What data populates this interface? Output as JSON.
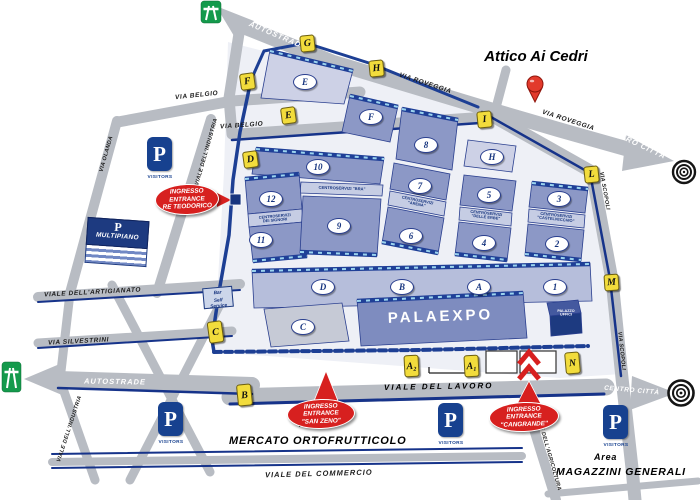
{
  "title": "Attico Ai Cedri",
  "colors": {
    "entrance_red": "#d7201f",
    "navy": "#1d3f94",
    "hall_blue": "#8c98c6",
    "gate_yellow": "#f2dc3c",
    "road_gray": "#b8bcc3",
    "highway_green": "#149a4c",
    "pin_red": "#e23a2c"
  },
  "gates": {
    "g": "G",
    "h": "H",
    "f": "F",
    "e": "E",
    "d": "D",
    "i": "I",
    "l": "L",
    "m": "M",
    "c": "C",
    "b": "B",
    "a2": "A₂",
    "a1": "A₁",
    "n": "N"
  },
  "halls": {
    "e": "E",
    "f": "F",
    "h": "H",
    "hall10": "10",
    "hall12": "12",
    "hall11": "11",
    "hall9": "9",
    "hall8": "8",
    "hall7": "7",
    "hall6": "6",
    "hall5": "5",
    "hall4": "4",
    "hall3": "3",
    "hall2": "2",
    "hall1": "1",
    "a": "A",
    "b": "B",
    "c": "C",
    "d": "D"
  },
  "centroservizi": {
    "bra": "CENTROSERVIZI \"BRA\"",
    "signori_l1": "CENTROSERVIZI",
    "signori_l2": "DEI SIGNORI",
    "arena_l1": "CENTROSERVIZI",
    "arena_l2": "\"ARENA\"",
    "erbe_l1": "CENTROSERVIZI",
    "erbe_l2": "\"DELLE ERBE\"",
    "castelvecchio_l1": "CENTROSERVIZI",
    "castelvecchio_l2": "\"CASTELVECCHIO\""
  },
  "entrances": {
    "teodorico_l1": "INGRESSO",
    "teodorico_l2": "ENTRANCE",
    "teodorico_l3": "RE TEODORICO",
    "sanzeno_l1": "INGRESSO",
    "sanzeno_l2": "ENTRANCE",
    "sanzeno_l3": "\"SAN ZENO\"",
    "cangrande_l1": "INGRESSO",
    "cangrande_l2": "ENTRANCE",
    "cangrande_l3": "\"CANGRANDE\""
  },
  "roads": {
    "autostrade_top": "AUTOSTRADE",
    "autostrade_bottom": "AUTOSTRADE",
    "via_roveggia_1": "VIA ROVEGGIA",
    "via_roveggia_2": "VIA ROVEGGIA",
    "centro_citta_top": "CENTRO CITTÀ",
    "centro_citta_bottom": "CENTRO CITTÀ",
    "via_scopoli_1": "VIA SCOPOLI",
    "via_scopoli_2": "VIA SCOPOLI",
    "via_belgio_1": "VIA BELGIO",
    "via_belgio_2": "VIA BELGIO",
    "via_olanda": "VIA OLANDA",
    "viale_dell_industria_1": "VIALE DELL'INDUSTRIA",
    "viale_dell_industria_2": "VIALE DELL'INDUSTRIA",
    "viale_dell_artigianato": "VIALE DELL'ARTIGIANATO",
    "via_silvestrini": "VIA SILVESTRINI",
    "viale_del_lavoro": "VIALE DEL LAVORO",
    "viale_del_commercio": "VIALE DEL COMMERCIO",
    "viale_dell_agricoltura": "VIALE DELL'AGRICOLTURA"
  },
  "buildings": {
    "palaexpo": "PALAEXPO",
    "palazzo_uffici_l1": "PALAZZO",
    "palazzo_uffici_l2": "UFFICI",
    "multipiano_p": "P",
    "multipiano": "MULTIPIANO",
    "bar_l1": "Bar",
    "bar_l2": "Self Service"
  },
  "areas": {
    "mercato_area": "Area",
    "mercato": "MERCATO ORTOFRUTTICOLO",
    "magazzini_area": "Area",
    "magazzini": "MAGAZZINI GENERALI"
  },
  "parking": {
    "p": "P",
    "visitors": "VISITORS"
  }
}
